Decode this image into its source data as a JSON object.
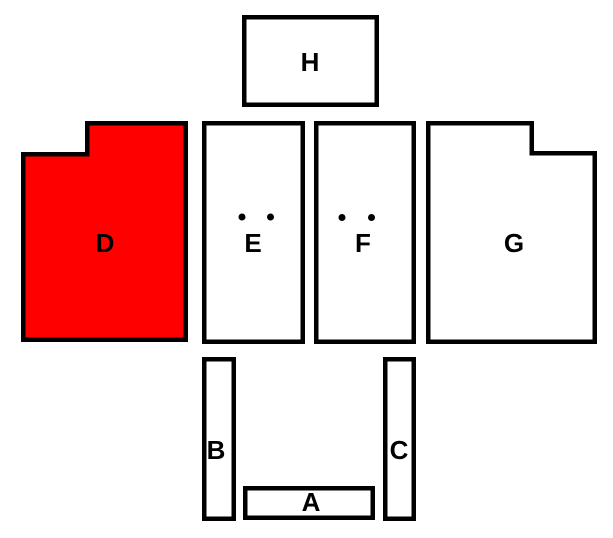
{
  "diagram": {
    "background_color": "#ffffff",
    "outline_color": "#000000",
    "shape_fill": "#ffffff",
    "highlight_color": "#ff0000",
    "highlighted_shape": "D",
    "shapes": [
      {
        "label": "A"
      },
      {
        "label": "B"
      },
      {
        "label": "C"
      },
      {
        "label": "D"
      },
      {
        "label": "E"
      },
      {
        "label": "F"
      },
      {
        "label": "G"
      },
      {
        "label": "H"
      }
    ],
    "dot_marks": {
      "E": 2,
      "F": 2
    }
  }
}
